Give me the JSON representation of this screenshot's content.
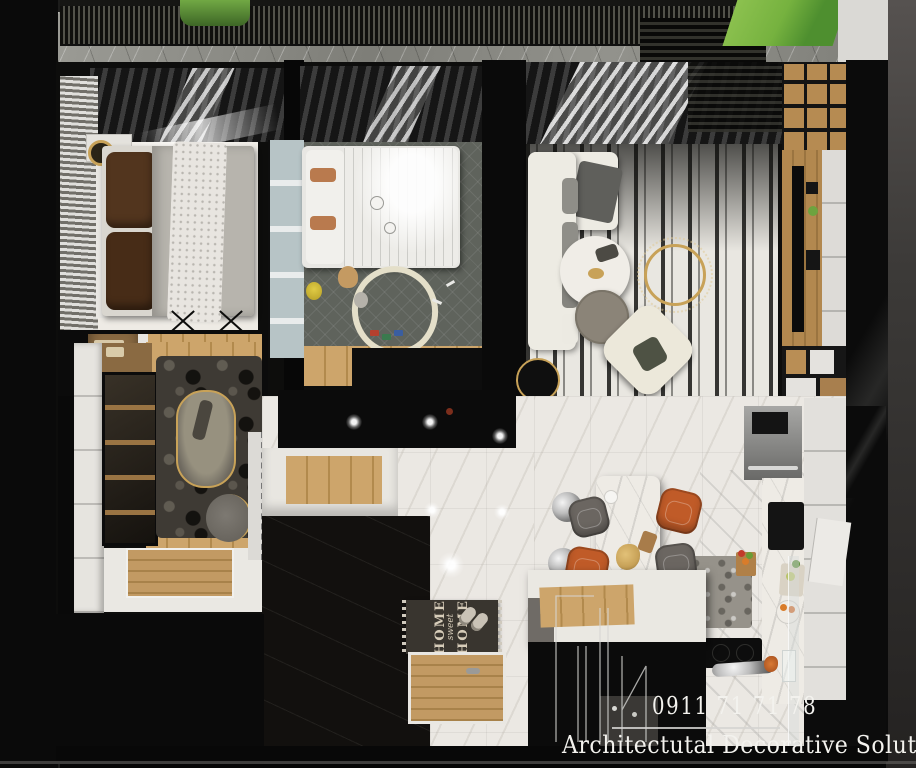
{
  "branding": {
    "phone": "0911 71 71 78",
    "company": "Architectutal Decorative Solutions"
  },
  "doormat": {
    "word_top": "HOME",
    "word_middle": "sweet",
    "word_bottom": "HOME"
  },
  "palette": {
    "backdrop": "#060606",
    "wall_black": "#0b0b0b",
    "frame_gray": "#45423f",
    "balcony_marble": "#8f8f89",
    "floor_white": "#efece6",
    "floor_tile": "#ebe8e3",
    "wood": "#c49c63",
    "wood_dark": "#9c7747",
    "curtain_dark": "#2b2b2b",
    "rug_kids": "#5f635c",
    "rug_stripe_base": "#e9e7e1",
    "stone_dark": "#3e3a34",
    "sofa_white": "#edebe3",
    "pillow_brown": "#52351e",
    "duvet_gray": "#b7b4ad",
    "mirror_blue": "#b7c4c6",
    "accent_gold": "#c8a258",
    "chair_orange": "#c05b28",
    "chair_gray": "#6b6661",
    "table_gray": "#8b8478",
    "armchair_cream": "#ece8da",
    "plant_green": "#679f3c",
    "landscape_green": "#76b23f",
    "text_white": "#f3f2ee",
    "doormat_dark": "#39352f",
    "doormat_text": "#d6ccb9"
  }
}
